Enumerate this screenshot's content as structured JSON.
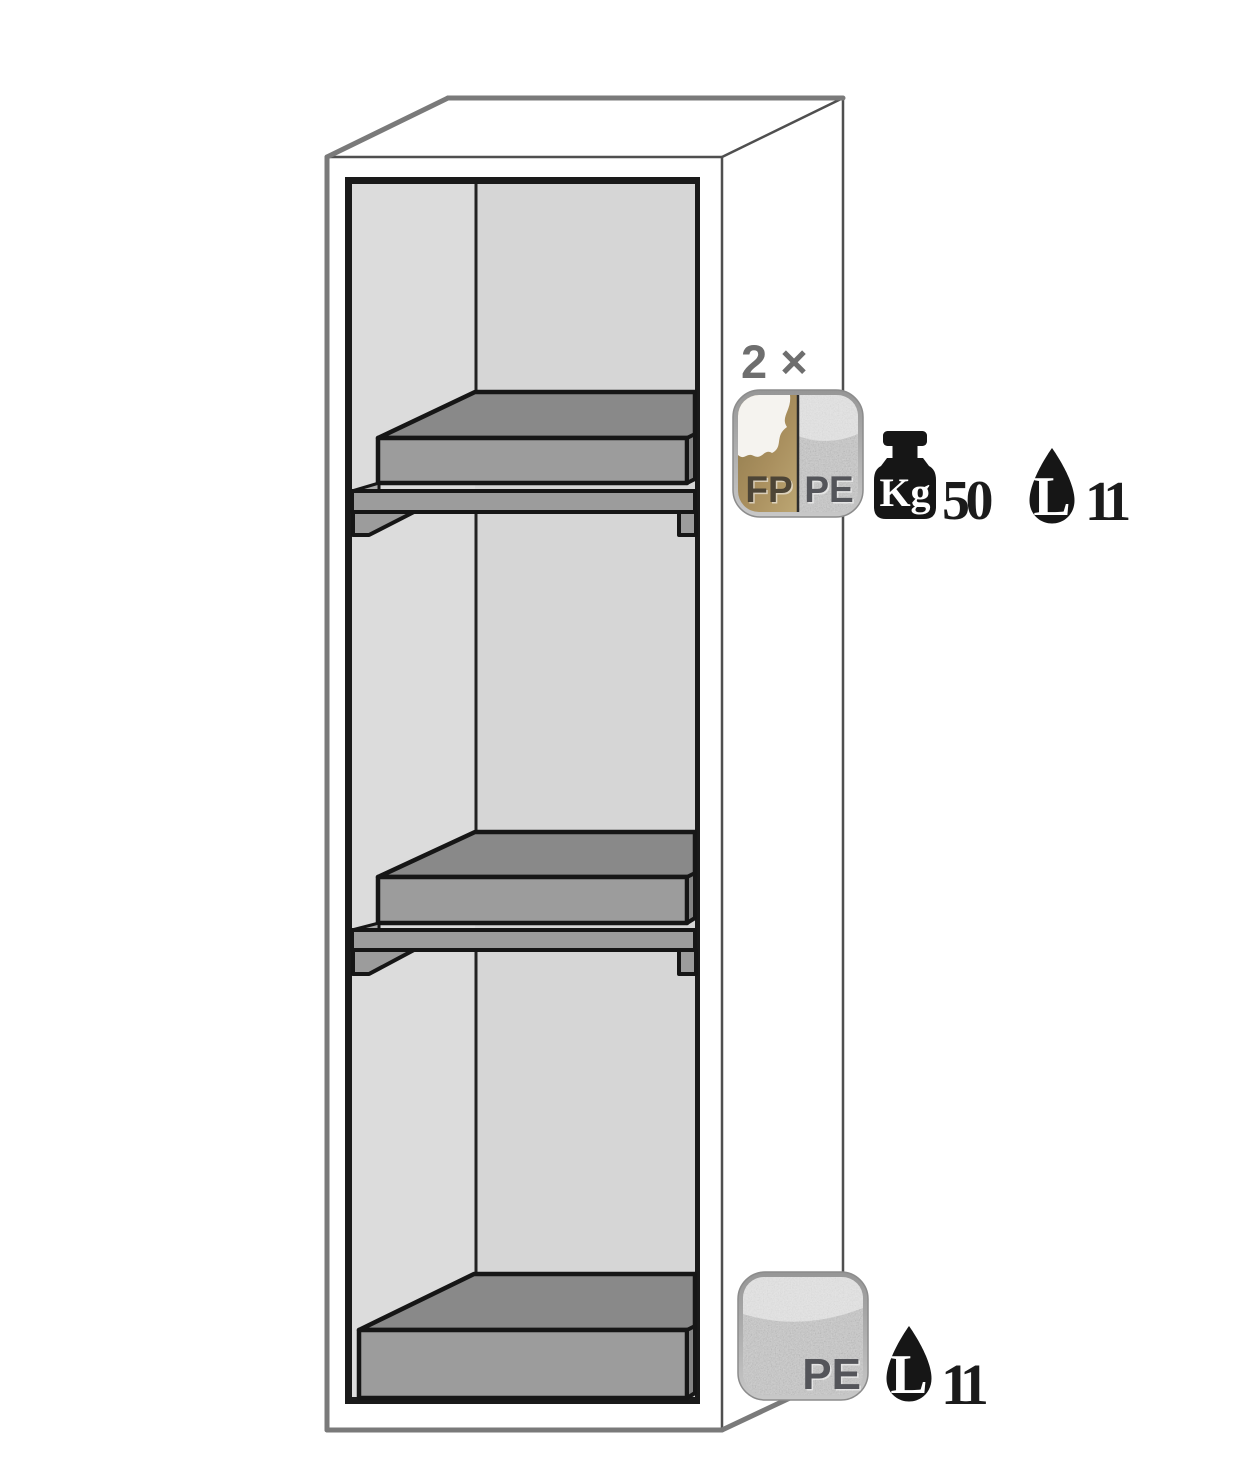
{
  "figure": {
    "alt": "Line drawing of a tall safety cabinet shown in perspective with two interior shelf trays and one bottom sump tray",
    "shelf_annotation": {
      "quantity_label": "2 ×",
      "material_badge": {
        "left": "FP",
        "right": "PE"
      },
      "load_unit": "Kg",
      "load_value": "50",
      "volume_unit": "L",
      "volume_value": "11"
    },
    "sump_annotation": {
      "material_label": "PE",
      "volume_unit": "L",
      "volume_value": "11"
    },
    "colors": {
      "outline_gray": "#7a7a7a",
      "edge_dark": "#4f4f4f",
      "line_black": "#1a1a1a",
      "wall_left": "#dcdcdc",
      "wall_back": "#d6d6d6",
      "tray_top": "#898989",
      "tray_front": "#9c9c9c",
      "tray_side": "#838383",
      "shelf": "#9c9c9c",
      "badge_silver": "#cacaca",
      "badge_gold": "#a58c58",
      "spill_white": "#f5f3ef",
      "badge_text": "#54555a",
      "badge_text_gold": "#4d4536",
      "icon_black": "#161616",
      "label_gray": "#6e6e6e"
    }
  }
}
